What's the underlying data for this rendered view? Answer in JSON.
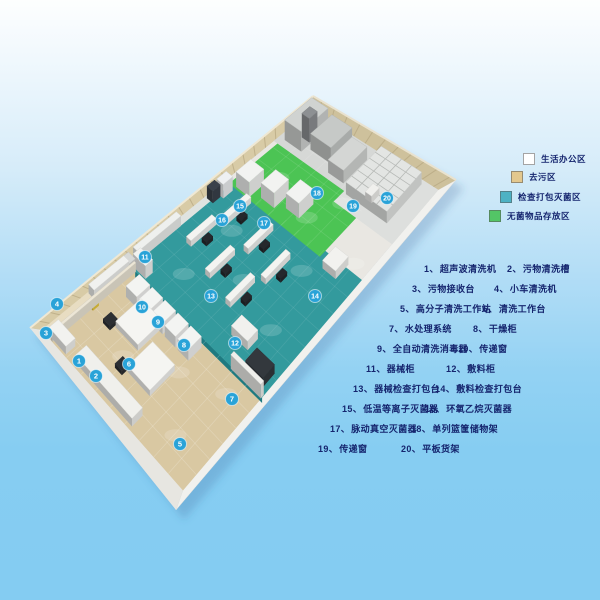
{
  "page": {
    "background_top": "#fdfefe",
    "background_bottom": "#84ccf2",
    "title": "消毒供应中心平面布局图"
  },
  "legend": {
    "items": [
      {
        "label": "生活办公区",
        "color": "#ffffff"
      },
      {
        "label": "去污区",
        "color": "#e3c88e"
      },
      {
        "label": "检查打包灭菌区",
        "color": "#4db2c4"
      },
      {
        "label": "无菌物品存放区",
        "color": "#53c566"
      }
    ]
  },
  "floorplan": {
    "marker_color": "#29a3d8",
    "zone_colors": {
      "office_corridor": "#e8ddc2",
      "decontamination": "#d9c8a2",
      "inspection_packing_sterilization": "#339a9d",
      "sterile_storage": "#4cc454",
      "machine_room": "#d6d8d6",
      "rack_area": "#dddfdd"
    },
    "markers": [
      "1",
      "2",
      "3",
      "4",
      "5",
      "6",
      "7",
      "8",
      "9",
      "10",
      "11",
      "12",
      "13",
      "14",
      "15",
      "16",
      "17",
      "18",
      "19",
      "20"
    ]
  },
  "equipment_list": {
    "items": [
      {
        "no": "1、",
        "name": "超声波清洗机"
      },
      {
        "no": "2、",
        "name": "污物清洗槽"
      },
      {
        "no": "3、",
        "name": "污物接收台"
      },
      {
        "no": "4、",
        "name": "小车清洗机"
      },
      {
        "no": "5、",
        "name": "高分子清洗工作站"
      },
      {
        "no": "6、",
        "name": "清洗工作台"
      },
      {
        "no": "7、",
        "name": "水处理系统"
      },
      {
        "no": "8、",
        "name": "干燥柜"
      },
      {
        "no": "9、",
        "name": "全自动清洗消毒器"
      },
      {
        "no": "10、",
        "name": "传递窗"
      },
      {
        "no": "11、",
        "name": "器械柜"
      },
      {
        "no": "12、",
        "name": "敷料柜"
      },
      {
        "no": "13、",
        "name": "器械检查打包台"
      },
      {
        "no": "14、",
        "name": "敷料检查打包台"
      },
      {
        "no": "15、",
        "name": "低温等离子灭菌器"
      },
      {
        "no": "16、",
        "name": "环氧乙烷灭菌器"
      },
      {
        "no": "17、",
        "name": "脉动真空灭菌器"
      },
      {
        "no": "18、",
        "name": "单列篮筐储物架"
      },
      {
        "no": "19、",
        "name": "传递窗"
      },
      {
        "no": "20、",
        "name": "平板货架"
      }
    ]
  }
}
